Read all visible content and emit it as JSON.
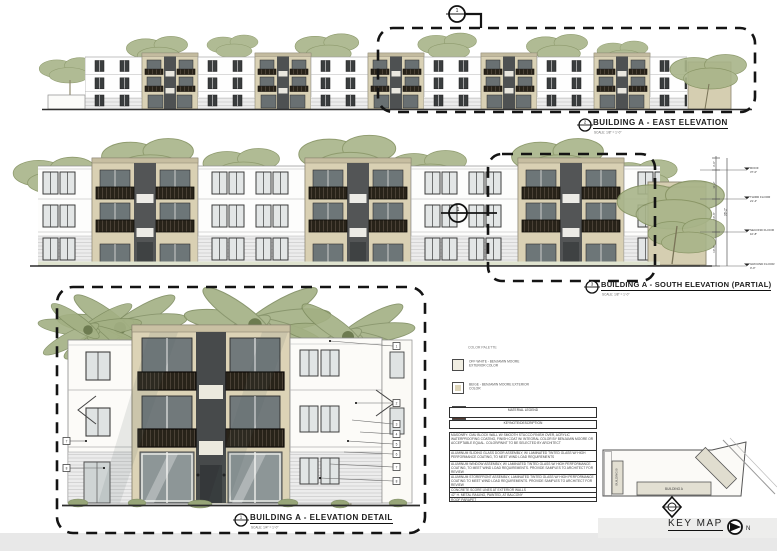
{
  "titles": {
    "east": {
      "ref": "2",
      "label": "BUILDING A - EAST ELEVATION",
      "scale": "SCALE: 1/8\" = 1'-0\""
    },
    "south": {
      "ref": "3",
      "label": "BUILDING A - SOUTH ELEVATION (PARTIAL)",
      "scale": "SCALE: 1/8\" = 1'-0\""
    },
    "detail": {
      "ref": "1",
      "label": "BUILDING A - ELEVATION DETAIL",
      "scale": "SCALE: 1/4\" = 1'-0\""
    }
  },
  "callouts": {
    "east_box": "1",
    "south_box": "1"
  },
  "palette": {
    "header": "COLOR PALETTE",
    "items": [
      {
        "num": "1",
        "label": "OFF WHITE - BENJAMIN MOORE EXTERIOR COLOR",
        "swatch": "#f1eee2"
      },
      {
        "num": "2",
        "label": "BEIGE - BENJAMIN MOORE EXTERIOR COLOR",
        "swatch": "#ddd4b8"
      },
      {
        "num": "3",
        "label": "BROWN ON TEXTURED WALL - BENJAMIN MOORE EXTERIOR WALL",
        "swatch": "#53382f"
      }
    ]
  },
  "legend": {
    "title": "MATERIAL LEGEND",
    "subtitle": "KEYNOTE/DESCRIPTION",
    "rows": [
      {
        "text": "MASONRY: CMU BLOCK WALL W/ SMOOTH STUCCO FINISH OVER, ACRYLIC WATERPROOFING COATING, FINISH COAT W/ INTEGRAL COLOR BY BENJAMIN MOORE OR ACCEPTABLE EQUAL. COLOR/PAINT TO BE SELECTED BY ARCHITECT"
      },
      {
        "text": "ALUMINUM SLIDING GLASS DOOR ASSEMBLY, W/ LAMINATED TINTED GLASS W/ HIGH PERFORMANCE COATING, TO MEET WIND LOAD REQUIREMENTS"
      },
      {
        "text": "ALUMINUM WINDOW ASSEMBLY, W/ LAMINATED TINTED GLASS W/ HIGH PERFORMANCE COATING, TO MEET WIND LOAD REQUIREMENTS. PROVIDE SAMPLES TO ARCHITECT FOR REVIEW"
      },
      {
        "text": "ALUMINUM STOREFRONT ASSEMBLY, LAMINATED TINTED GLASS W/ HIGH PERFORMANCE COATING TO MEET WIND LOAD REQUIREMENTS. PROVIDE SAMPLES TO ARCHITECT FOR REVIEW"
      },
      {
        "text": "CONCRETE SCORE LINES AT EXTERIOR WALLS"
      },
      {
        "text": "42\" H. METAL RAILING, PAINTED, AT BALCONY"
      },
      {
        "text": "ROOF PARAPET"
      }
    ]
  },
  "levels": [
    {
      "name": "ROOF",
      "elev": "37'-0\""
    },
    {
      "name": "THIRD FLOOR",
      "elev": "21'-4\""
    },
    {
      "name": "SECOND FLOOR",
      "elev": "10'-8\""
    },
    {
      "name": "GROUND FLOOR",
      "elev": "0'-0\""
    }
  ],
  "dims": {
    "parapet": "3'-0\"",
    "third": "11'-2\"",
    "second": "10'-8\"",
    "ground": "10'-8\"",
    "overall": "36'-2\""
  },
  "keynotes": [
    "1",
    "2",
    "3",
    "4",
    "5",
    "6",
    "7",
    "8"
  ],
  "keymap": {
    "label": "KEY MAP",
    "north": "N",
    "building_a": "BUILDING A",
    "building_b": "BUILDING B"
  },
  "colors": {
    "beige": "#d9d1b5",
    "offwhite": "#fcfbf8",
    "brown": "#53382f",
    "window_glass": "#6d7678",
    "railing": "#2e2822",
    "foliage": "#a8b489"
  }
}
